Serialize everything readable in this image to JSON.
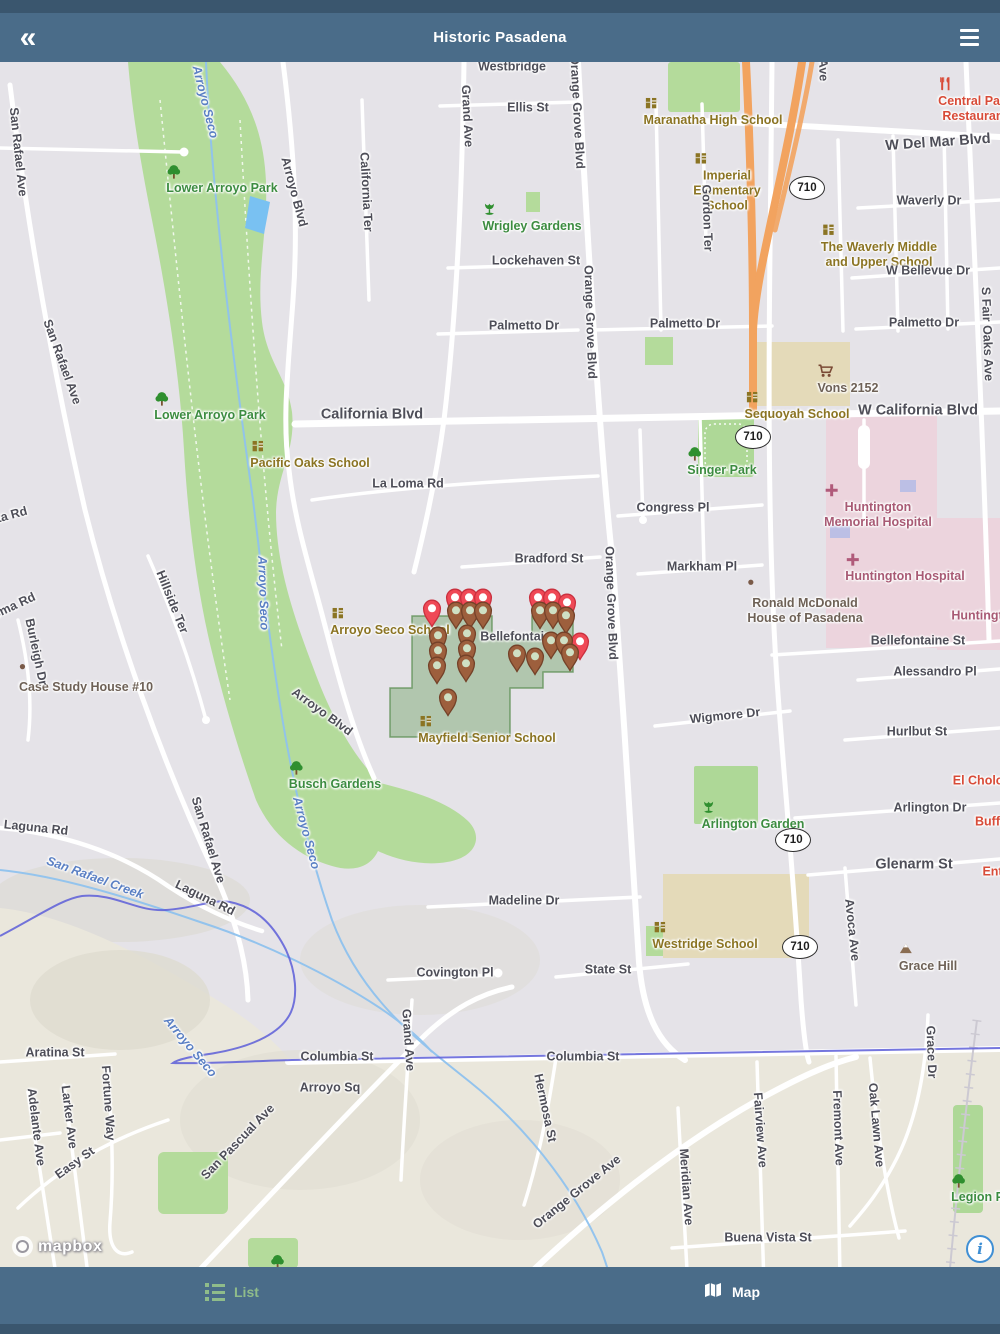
{
  "app": {
    "title": "Historic Pasadena",
    "back_icon": "double-chevron-left",
    "menu_icon": "hamburger"
  },
  "tabbar": {
    "list_label": "List",
    "map_label": "Map",
    "active_tab": "Map"
  },
  "attribution": {
    "logo_text": "mapbox",
    "info_icon": "i"
  },
  "colors": {
    "bar": "#4a6c89",
    "bar_dark": "#3a566e",
    "tab_inactive": "#8fbc8a",
    "tab_active": "#ffffff",
    "pin_red": "#ef4956",
    "pin_brown": "#9d5f3d",
    "park_green": "#b4db9b",
    "hospital_pink": "#ecd4dd",
    "freeway_orange": "#f2a35f",
    "boundary_purple": "#5d5ed8",
    "selection_green": "rgba(104,158,92,0.42)"
  },
  "map": {
    "shields": [
      {
        "text": "710",
        "x": 807,
        "y": 188
      },
      {
        "text": "710",
        "x": 753,
        "y": 437
      },
      {
        "text": "710",
        "x": 793,
        "y": 840
      },
      {
        "text": "710",
        "x": 800,
        "y": 947
      }
    ],
    "labels": [
      {
        "t": "Westbridge",
        "x": 512,
        "y": 67,
        "c": "street"
      },
      {
        "t": "San Rafael Ave",
        "x": 18,
        "y": 152,
        "r": 84,
        "c": "street"
      },
      {
        "t": "San Rafael Ave",
        "x": 62,
        "y": 362,
        "r": 70,
        "c": "street"
      },
      {
        "t": "Arroyo Seco",
        "x": 205,
        "y": 102,
        "r": 76,
        "c": "water"
      },
      {
        "t": "Lower Arroyo Park",
        "x": 222,
        "y": 180,
        "c": "park",
        "icon": "tree"
      },
      {
        "t": "Arroyo Blvd",
        "x": 294,
        "y": 192,
        "r": 75,
        "c": "street"
      },
      {
        "t": "California Ter",
        "x": 366,
        "y": 192,
        "r": 87,
        "c": "street"
      },
      {
        "t": "Grand Ave",
        "x": 467,
        "y": 116,
        "r": 87,
        "c": "street"
      },
      {
        "t": "Ellis St",
        "x": 528,
        "y": 108,
        "c": "street"
      },
      {
        "t": "Orange Grove Blvd",
        "x": 577,
        "y": 112,
        "r": 87,
        "c": "street"
      },
      {
        "t": "Maranatha High School",
        "x": 713,
        "y": 112,
        "c": "school",
        "icon": "school"
      },
      {
        "t": "Ave",
        "x": 823,
        "y": 70,
        "r": 88,
        "c": "street"
      },
      {
        "t": "Central Park\nRestaurant",
        "x": 975,
        "y": 100,
        "c": "poi-red",
        "icon": "restaurant"
      },
      {
        "t": "W Del Mar Blvd",
        "x": 938,
        "y": 143,
        "r": -4,
        "c": "street",
        "big": true
      },
      {
        "t": "Imperial\nElementary\nSchool",
        "x": 727,
        "y": 182,
        "c": "school",
        "icon": "school"
      },
      {
        "t": "Wrigley Gardens",
        "x": 532,
        "y": 218,
        "c": "park",
        "icon": "flower"
      },
      {
        "t": "Waverly Dr",
        "x": 929,
        "y": 201,
        "c": "street"
      },
      {
        "t": "The Waverly Middle\nand Upper School",
        "x": 879,
        "y": 246,
        "c": "school",
        "icon": "school"
      },
      {
        "t": "Gordon Ter",
        "x": 707,
        "y": 218,
        "r": 88,
        "c": "street"
      },
      {
        "t": "Lockehaven St",
        "x": 536,
        "y": 261,
        "c": "street"
      },
      {
        "t": "W Bellevue Dr",
        "x": 928,
        "y": 271,
        "c": "street"
      },
      {
        "t": "Palmetto Dr",
        "x": 524,
        "y": 326,
        "c": "street"
      },
      {
        "t": "Palmetto Dr",
        "x": 685,
        "y": 324,
        "c": "street"
      },
      {
        "t": "Palmetto Dr",
        "x": 924,
        "y": 323,
        "c": "street"
      },
      {
        "t": "S Fair Oaks Ave",
        "x": 987,
        "y": 334,
        "r": 88,
        "c": "street"
      },
      {
        "t": "Orange Grove Blvd",
        "x": 590,
        "y": 322,
        "r": 88,
        "c": "street"
      },
      {
        "t": "Vons 2152",
        "x": 848,
        "y": 380,
        "c": "poi-gray",
        "icon": "cart"
      },
      {
        "t": "Sequoyah School",
        "x": 797,
        "y": 406,
        "c": "school",
        "icon": "school"
      },
      {
        "t": "W California Blvd",
        "x": 918,
        "y": 411,
        "c": "street",
        "big": true
      },
      {
        "t": "California Blvd",
        "x": 372,
        "y": 415,
        "c": "street",
        "big": true
      },
      {
        "t": "Lower Arroyo Park",
        "x": 210,
        "y": 407,
        "c": "park",
        "icon": "tree"
      },
      {
        "t": "Pacific Oaks School",
        "x": 310,
        "y": 455,
        "c": "school",
        "icon": "school"
      },
      {
        "t": "Singer Park",
        "x": 722,
        "y": 462,
        "c": "park",
        "icon": "tree"
      },
      {
        "t": "La Loma Rd",
        "x": 408,
        "y": 484,
        "c": "street"
      },
      {
        "t": "Congress Pl",
        "x": 673,
        "y": 508,
        "c": "street"
      },
      {
        "t": "Huntington\nMemorial Hospital",
        "x": 878,
        "y": 506,
        "c": "hospital",
        "icon": "cross"
      },
      {
        "t": "ta Rd",
        "x": 12,
        "y": 515,
        "r": -15,
        "c": "street"
      },
      {
        "t": "Bradford St",
        "x": 549,
        "y": 559,
        "c": "street"
      },
      {
        "t": "Markham Pl",
        "x": 702,
        "y": 567,
        "c": "street"
      },
      {
        "t": "Huntington Hospital",
        "x": 905,
        "y": 568,
        "c": "hospital",
        "icon": "cross"
      },
      {
        "t": "Hillside Ter",
        "x": 172,
        "y": 602,
        "r": 68,
        "c": "street"
      },
      {
        "t": "oma Rd",
        "x": 14,
        "y": 606,
        "r": -25,
        "c": "street"
      },
      {
        "t": "Arroyo Seco",
        "x": 263,
        "y": 593,
        "r": 88,
        "c": "water"
      },
      {
        "t": "Orange Grove Blvd",
        "x": 611,
        "y": 603,
        "r": 88,
        "c": "street"
      },
      {
        "t": "Ronald McDonald\nHouse of Pasadena",
        "x": 805,
        "y": 602,
        "c": "poi-gray",
        "icon": "dot"
      },
      {
        "t": "Huntingt",
        "x": 977,
        "y": 616,
        "c": "hospital"
      },
      {
        "t": "Bellefontaine St",
        "x": 918,
        "y": 641,
        "c": "street"
      },
      {
        "t": "Case Study House #10",
        "x": 86,
        "y": 679,
        "c": "poi-gray",
        "icon": "dot"
      },
      {
        "t": "Burleigh Dr",
        "x": 36,
        "y": 652,
        "r": 78,
        "c": "street"
      },
      {
        "t": "Arroyo Seco School",
        "x": 390,
        "y": 622,
        "c": "school",
        "icon": "school"
      },
      {
        "t": "Bellefontain",
        "x": 516,
        "y": 637,
        "c": "street"
      },
      {
        "t": "Alessandro Pl",
        "x": 935,
        "y": 672,
        "c": "street"
      },
      {
        "t": "Arroyo Blvd",
        "x": 322,
        "y": 712,
        "r": 36,
        "c": "street"
      },
      {
        "t": "Wigmore Dr",
        "x": 725,
        "y": 716,
        "r": -6,
        "c": "street"
      },
      {
        "t": "Mayfield Senior School",
        "x": 487,
        "y": 730,
        "c": "school",
        "icon": "school"
      },
      {
        "t": "Hurlbut St",
        "x": 917,
        "y": 732,
        "c": "street"
      },
      {
        "t": "Busch Gardens",
        "x": 335,
        "y": 776,
        "c": "park",
        "icon": "tree"
      },
      {
        "t": "El Cholo S",
        "x": 984,
        "y": 781,
        "c": "poi-red"
      },
      {
        "t": "Arlington Garden",
        "x": 753,
        "y": 816,
        "c": "park",
        "icon": "flower"
      },
      {
        "t": "Arlington Dr",
        "x": 930,
        "y": 808,
        "c": "street"
      },
      {
        "t": "Buffa",
        "x": 991,
        "y": 822,
        "c": "poi-red"
      },
      {
        "t": "San Rafael Ave",
        "x": 208,
        "y": 840,
        "r": 73,
        "c": "street"
      },
      {
        "t": "Laguna Rd",
        "x": 36,
        "y": 828,
        "r": 6,
        "c": "street"
      },
      {
        "t": "San Rafael Creek",
        "x": 95,
        "y": 878,
        "r": 20,
        "c": "water"
      },
      {
        "t": "Laguna Rd",
        "x": 205,
        "y": 898,
        "r": 26,
        "c": "street"
      },
      {
        "t": "Arroyo Seco",
        "x": 306,
        "y": 833,
        "r": 75,
        "c": "water"
      },
      {
        "t": "Glenarm St",
        "x": 914,
        "y": 865,
        "c": "street",
        "big": true
      },
      {
        "t": "Ente",
        "x": 996,
        "y": 872,
        "c": "poi-red"
      },
      {
        "t": "Madeline Dr",
        "x": 524,
        "y": 901,
        "c": "street"
      },
      {
        "t": "Avoca Ave",
        "x": 852,
        "y": 930,
        "r": 84,
        "c": "street"
      },
      {
        "t": "Westridge School",
        "x": 705,
        "y": 936,
        "c": "school",
        "icon": "school"
      },
      {
        "t": "Grace Hill",
        "x": 928,
        "y": 958,
        "c": "poi-gray",
        "icon": "mountain"
      },
      {
        "t": "Covington Pl",
        "x": 455,
        "y": 973,
        "c": "street"
      },
      {
        "t": "State St",
        "x": 608,
        "y": 970,
        "c": "street"
      },
      {
        "t": "Columbia St",
        "x": 337,
        "y": 1057,
        "c": "street"
      },
      {
        "t": "Columbia St",
        "x": 583,
        "y": 1057,
        "c": "street"
      },
      {
        "t": "Grand Ave",
        "x": 408,
        "y": 1040,
        "r": 86,
        "c": "street"
      },
      {
        "t": "Arroyo Sq",
        "x": 330,
        "y": 1088,
        "c": "street"
      },
      {
        "t": "Aratina St",
        "x": 55,
        "y": 1053,
        "c": "street"
      },
      {
        "t": "Arroyo Seco",
        "x": 190,
        "y": 1047,
        "r": 50,
        "c": "water"
      },
      {
        "t": "Fortune Way",
        "x": 108,
        "y": 1103,
        "r": 86,
        "c": "street"
      },
      {
        "t": "Larker Ave",
        "x": 69,
        "y": 1117,
        "r": 83,
        "c": "street"
      },
      {
        "t": "Adelante Ave",
        "x": 36,
        "y": 1127,
        "r": 83,
        "c": "street"
      },
      {
        "t": "Easy St",
        "x": 75,
        "y": 1163,
        "r": -36,
        "c": "street"
      },
      {
        "t": "San Pascual Ave",
        "x": 238,
        "y": 1142,
        "r": -46,
        "c": "street"
      },
      {
        "t": "Hermosa St",
        "x": 545,
        "y": 1108,
        "r": 78,
        "c": "street"
      },
      {
        "t": "Orange Grove Ave",
        "x": 577,
        "y": 1192,
        "r": -39,
        "c": "street"
      },
      {
        "t": "Meridian Ave",
        "x": 686,
        "y": 1187,
        "r": 86,
        "c": "street"
      },
      {
        "t": "Fairview Ave",
        "x": 760,
        "y": 1130,
        "r": 86,
        "c": "street"
      },
      {
        "t": "Fremont Ave",
        "x": 838,
        "y": 1128,
        "r": 88,
        "c": "street"
      },
      {
        "t": "Oak Lawn Ave",
        "x": 876,
        "y": 1125,
        "r": 85,
        "c": "street"
      },
      {
        "t": "Grace Dr",
        "x": 931,
        "y": 1052,
        "r": 88,
        "c": "street"
      },
      {
        "t": "Buena Vista St",
        "x": 768,
        "y": 1238,
        "c": "street"
      },
      {
        "t": "Legion Pa",
        "x": 981,
        "y": 1189,
        "c": "park",
        "icon": "tree"
      },
      {
        "t": "",
        "x": 270,
        "y": 1262,
        "c": "park",
        "icon": "tree"
      }
    ],
    "pins": [
      {
        "x": 432,
        "y": 608,
        "t": "red"
      },
      {
        "x": 455,
        "y": 597,
        "t": "red"
      },
      {
        "x": 469,
        "y": 597,
        "t": "red"
      },
      {
        "x": 483,
        "y": 597,
        "t": "red"
      },
      {
        "x": 538,
        "y": 597,
        "t": "red"
      },
      {
        "x": 552,
        "y": 597,
        "t": "red"
      },
      {
        "x": 567,
        "y": 602,
        "t": "red"
      },
      {
        "x": 580,
        "y": 641,
        "t": "red"
      },
      {
        "x": 456,
        "y": 610,
        "t": "brown"
      },
      {
        "x": 470,
        "y": 610,
        "t": "brown"
      },
      {
        "x": 483,
        "y": 610,
        "t": "brown"
      },
      {
        "x": 540,
        "y": 610,
        "t": "brown"
      },
      {
        "x": 553,
        "y": 610,
        "t": "brown"
      },
      {
        "x": 566,
        "y": 615,
        "t": "brown"
      },
      {
        "x": 438,
        "y": 635,
        "t": "brown"
      },
      {
        "x": 467,
        "y": 633,
        "t": "brown"
      },
      {
        "x": 438,
        "y": 650,
        "t": "brown"
      },
      {
        "x": 467,
        "y": 648,
        "t": "brown"
      },
      {
        "x": 437,
        "y": 665,
        "t": "brown"
      },
      {
        "x": 466,
        "y": 663,
        "t": "brown"
      },
      {
        "x": 551,
        "y": 640,
        "t": "brown"
      },
      {
        "x": 564,
        "y": 640,
        "t": "brown"
      },
      {
        "x": 517,
        "y": 653,
        "t": "brown"
      },
      {
        "x": 535,
        "y": 656,
        "t": "brown"
      },
      {
        "x": 570,
        "y": 652,
        "t": "brown"
      },
      {
        "x": 448,
        "y": 697,
        "t": "brown"
      }
    ]
  }
}
